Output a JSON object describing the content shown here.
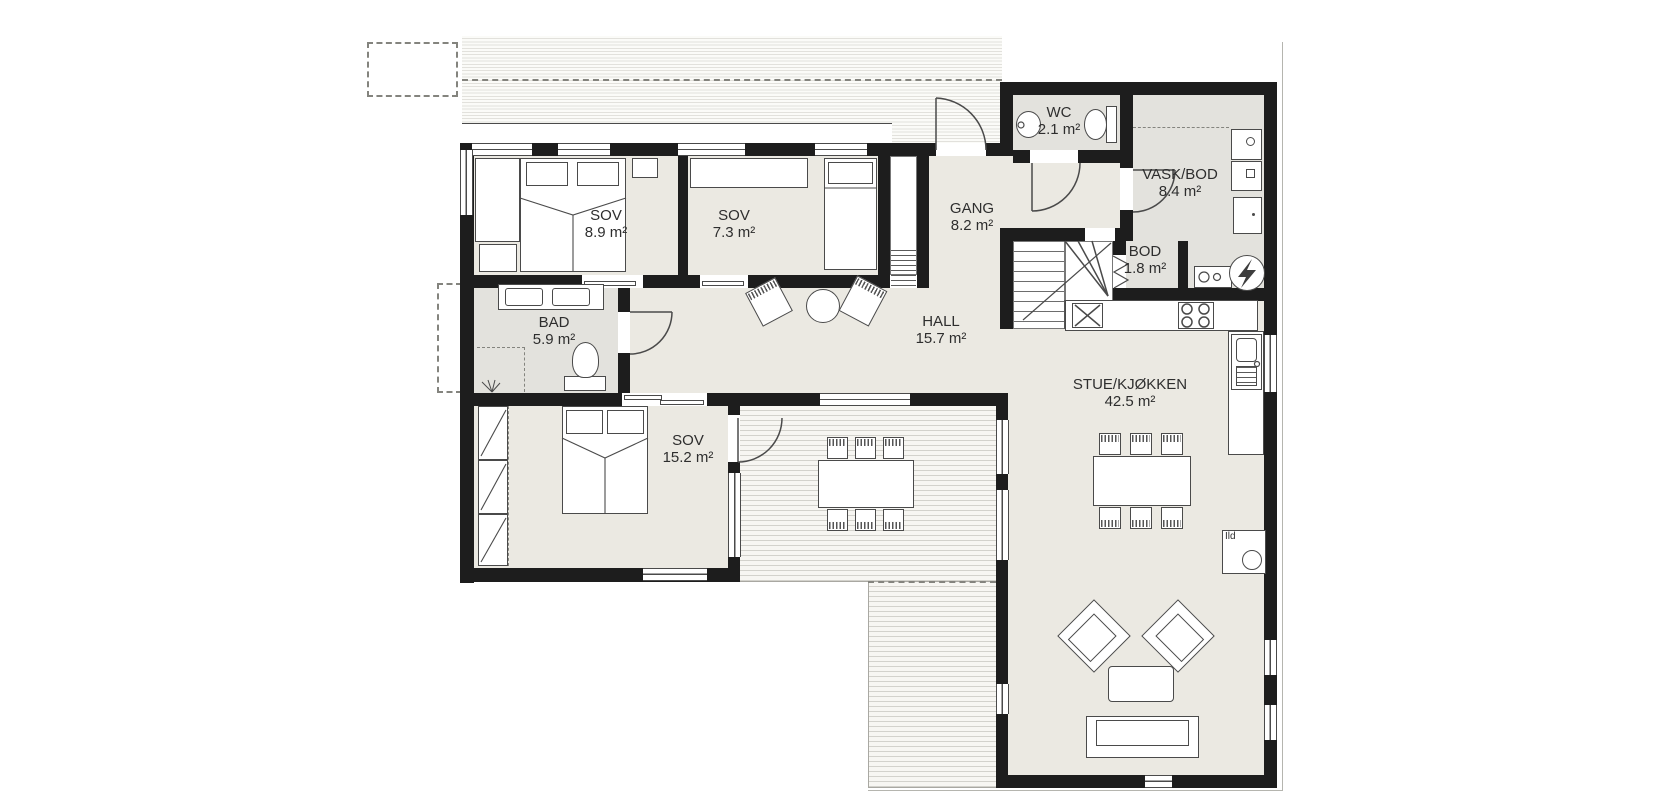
{
  "floorplan": {
    "rooms": [
      {
        "id": "sov-1",
        "name": "SOV",
        "area": "8.9 m²"
      },
      {
        "id": "sov-2",
        "name": "SOV",
        "area": "7.3 m²"
      },
      {
        "id": "gang",
        "name": "GANG",
        "area": "8.2 m²"
      },
      {
        "id": "wc",
        "name": "WC",
        "area": "2.1 m²"
      },
      {
        "id": "vask-bod",
        "name": "VASK/BOD",
        "area": "8.4 m²"
      },
      {
        "id": "bod",
        "name": "BOD",
        "area": "1.8 m²"
      },
      {
        "id": "bad",
        "name": "BAD",
        "area": "5.9 m²"
      },
      {
        "id": "hall",
        "name": "HALL",
        "area": "15.7 m²"
      },
      {
        "id": "sov-3",
        "name": "SOV",
        "area": "15.2 m²"
      },
      {
        "id": "stue-kjokken",
        "name": "STUE/KJØKKEN",
        "area": "42.5 m²"
      }
    ],
    "labels": {
      "fireplace": "Ild"
    },
    "colors": {
      "wall": "#1d1d1d",
      "floor": "#ebe9e2",
      "wet_floor": "#e3e2dd",
      "furniture_stroke": "#4a4a4a",
      "deck_line": "#d3d2cc"
    }
  }
}
